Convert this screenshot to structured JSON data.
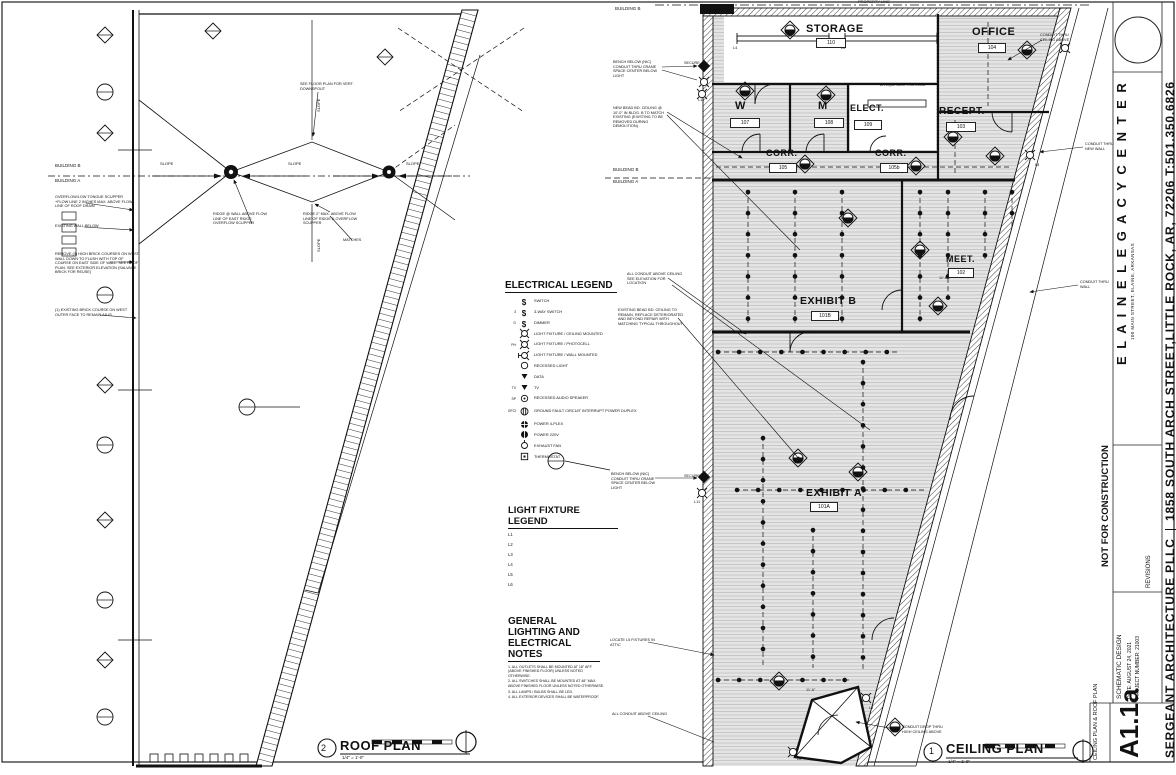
{
  "titleblock": {
    "project_name": "E L A I N E   L E G A C Y   C E N T E R",
    "project_address": "100 MAIN STREET, ELAINE, ARKANSAS",
    "firm_name": "SERGEANT ARCHITECTURE PLLC",
    "firm_address": "1858 SOUTH ARCH STREET,LITTLE ROCK, AR, 72206 T:501.350.6826",
    "status": "NOT FOR CONSTRUCTION",
    "phase": "SCHEMATIC DESIGN",
    "date_line": "DATE: AUGUST 24, 2021",
    "project_number_line": "PROJECT NUMBER: 21003",
    "revisions_label": "REVISIONS",
    "sheet_title": "CEILING PLAN & ROOF PLAN",
    "sheet_number": "A1.1a"
  },
  "roof_plan": {
    "number": "2",
    "title": "ROOF PLAN",
    "scale": "1/4\" = 1'-0\"",
    "building_b": "BUILDING B",
    "building_a": "BUILDING A",
    "slope": "SLOPE",
    "notes": {
      "downspout": "SEE FLOOR PLAN FOR VERT. DOWNSPOUT",
      "overflow_scupper": "OVERFLOW/LOW TONGUE SCUPPER +FLOW LINE 2 INCHES MAX. ABOVE FLOW LINE OF ROOF DRAIN",
      "existing_wall": "EXISTING WALL BELOW",
      "remove_brick": "REMOVE (3) HIGH BRICK COURSES ON WEST WALL DOWN TO FLUSH WITH TOP OF COURSE ON EAST SIDE OF WALL. SEE ROOF PLAN. SEE EXTERIOR ELEVATION (SALVAGE BRICK FOR REUSE)",
      "existing_course": "(1) EXISTING BRICK COURSE ON WEST OUTER FACE TO REMAIN AS IS",
      "ridge_wall": "RIDGE @ WALL ABOVE FLOW LINE OF EAST RIDGE OVERFLOW SCUPPER",
      "ridge_max": "RIDGE 2\" MAX. ABOVE FLOW LINE OF RIDGE & OVERFLOW SCUPPER",
      "matches": "MATCHES"
    }
  },
  "ceiling_plan": {
    "number": "1",
    "title": "CEILING PLAN",
    "scale": "1/4\" = 1'-0\"",
    "property_line": "PROPERTY LINE",
    "building_b": "BUILDING B",
    "building_a": "BUILDING A",
    "rooms": {
      "storage": {
        "name": "STORAGE",
        "number": "110"
      },
      "office": {
        "name": "OFFICE",
        "number": "104"
      },
      "w": {
        "name": "W",
        "number": "107"
      },
      "m": {
        "name": "M",
        "number": "108"
      },
      "elect": {
        "name": "ELECT.",
        "number": "109"
      },
      "recept": {
        "name": "RECEPT.",
        "number": "103"
      },
      "corr1": {
        "name": "CORR.",
        "number": "105"
      },
      "corr2": {
        "name": "CORR.",
        "number": "105b"
      },
      "meet": {
        "name": "MEET.",
        "number": "102"
      },
      "exhibit_b": {
        "name": "EXHIBIT B",
        "number": "101B"
      },
      "exhibit_a": {
        "name": "EXHIBIT A",
        "number": "101A"
      }
    },
    "tags": {
      "l4": "L4",
      "l8": "L8",
      "l11": "L11",
      "secure": "SECURE",
      "height_116": "11'-6\""
    },
    "notes": {
      "bench": "BENCH BELOW (NIC) CONDUIT THRU CRANE SPACE CENTER BELOW LIGHT",
      "new_ceiling": "NEW BEAD BD. CEILING @ 10'-0\" IN BLDG. B TO MATCH EXISTING (EXISTING TO BE REMOVED DURING DEMOLITION)",
      "conduit_elev": "ALL CONDUIT ABOVE CEILING SEE ELEVATION FOR LOCATION",
      "existing_ceiling": "EXISTING BEAD BD. CEILING TO REMAIN, REPLACE DETERIORATED AND BEYOND REPAIR WITH MATCHING TYPICAL THROUGHOUT",
      "conduit_ceiling": "CONDUIT THRU CEILING ABOVE",
      "conduit_wall_new": "CONDUIT THRU NEW WALL",
      "conduit_wall": "CONDUIT THRU WALL",
      "conduit_all": "ALL CONDUIT ABOVE CEILING",
      "conduit_drop": "CONDUIT DROP THRU HIGH CEILING ABOVE",
      "locate_l5": "LOCATE L5 FIXTURES IN ATTIC",
      "av": "A/V EQUIPMENT THIS ROOM"
    }
  },
  "electrical_legend": {
    "title": "ELECTRICAL LEGEND",
    "items": [
      {
        "tag": "",
        "symbol_char": "$",
        "label": "SWITCH"
      },
      {
        "tag": "3",
        "symbol_char": "$",
        "label": "3-WAY SWITCH"
      },
      {
        "tag": "D",
        "symbol_char": "$",
        "label": "DIMMER"
      },
      {
        "tag": "",
        "symbol_char": "",
        "label": "LIGHT FIXTURE / CEILING MOUNTED"
      },
      {
        "tag": "PH",
        "symbol_char": "",
        "label": "LIGHT FIXTURE / PHOTOCELL"
      },
      {
        "tag": "",
        "symbol_char": "",
        "label": "LIGHT FIXTURE / WALL MOUNTED"
      },
      {
        "tag": "",
        "symbol_char": "",
        "label": "RECESSED LIGHT"
      },
      {
        "tag": "",
        "symbol_char": "",
        "label": "DATA"
      },
      {
        "tag": "TV",
        "symbol_char": "",
        "label": "TV"
      },
      {
        "tag": "SP",
        "symbol_char": "",
        "label": "RECESSED AUDIO SPEAKER"
      },
      {
        "tag": "GFCI",
        "symbol_char": "",
        "label": "GROUND FAULT CIRCUIT INTERRUPT POWER DUPLEX"
      },
      {
        "tag": "",
        "symbol_char": "",
        "label": "POWER 4-PLEX"
      },
      {
        "tag": "",
        "symbol_char": "",
        "label": "POWER 220V"
      },
      {
        "tag": "",
        "symbol_char": "",
        "label": "EXHAUST FAN"
      },
      {
        "tag": "",
        "symbol_char": "",
        "label": "THERMOSTAT"
      }
    ]
  },
  "light_fixture_legend": {
    "title": "LIGHT FIXTURE LEGEND",
    "items": [
      "L1",
      "L2",
      "L3",
      "L4",
      "L5",
      "L6"
    ]
  },
  "general_notes": {
    "title_1": "GENERAL LIGHTING AND",
    "title_2": "ELECTRICAL NOTES",
    "items": [
      "1. ALL OUTLETS SHALL BE MOUNTED AT 18\" AFF (ABOVE FINISHED FLOOR) UNLESS NOTED OTHERWISE.",
      "2. ALL SWITCHES SHALL BE MOUNTED AT 48\" MAX. ABOVE FINISHED FLOOR UNLESS NOTED OTHERWISE.",
      "3. ALL LAMPS / BULBS SHALL BE LED.",
      "4. ALL EXTERIOR DEVICES SHALL BE WATERPROOF."
    ]
  }
}
